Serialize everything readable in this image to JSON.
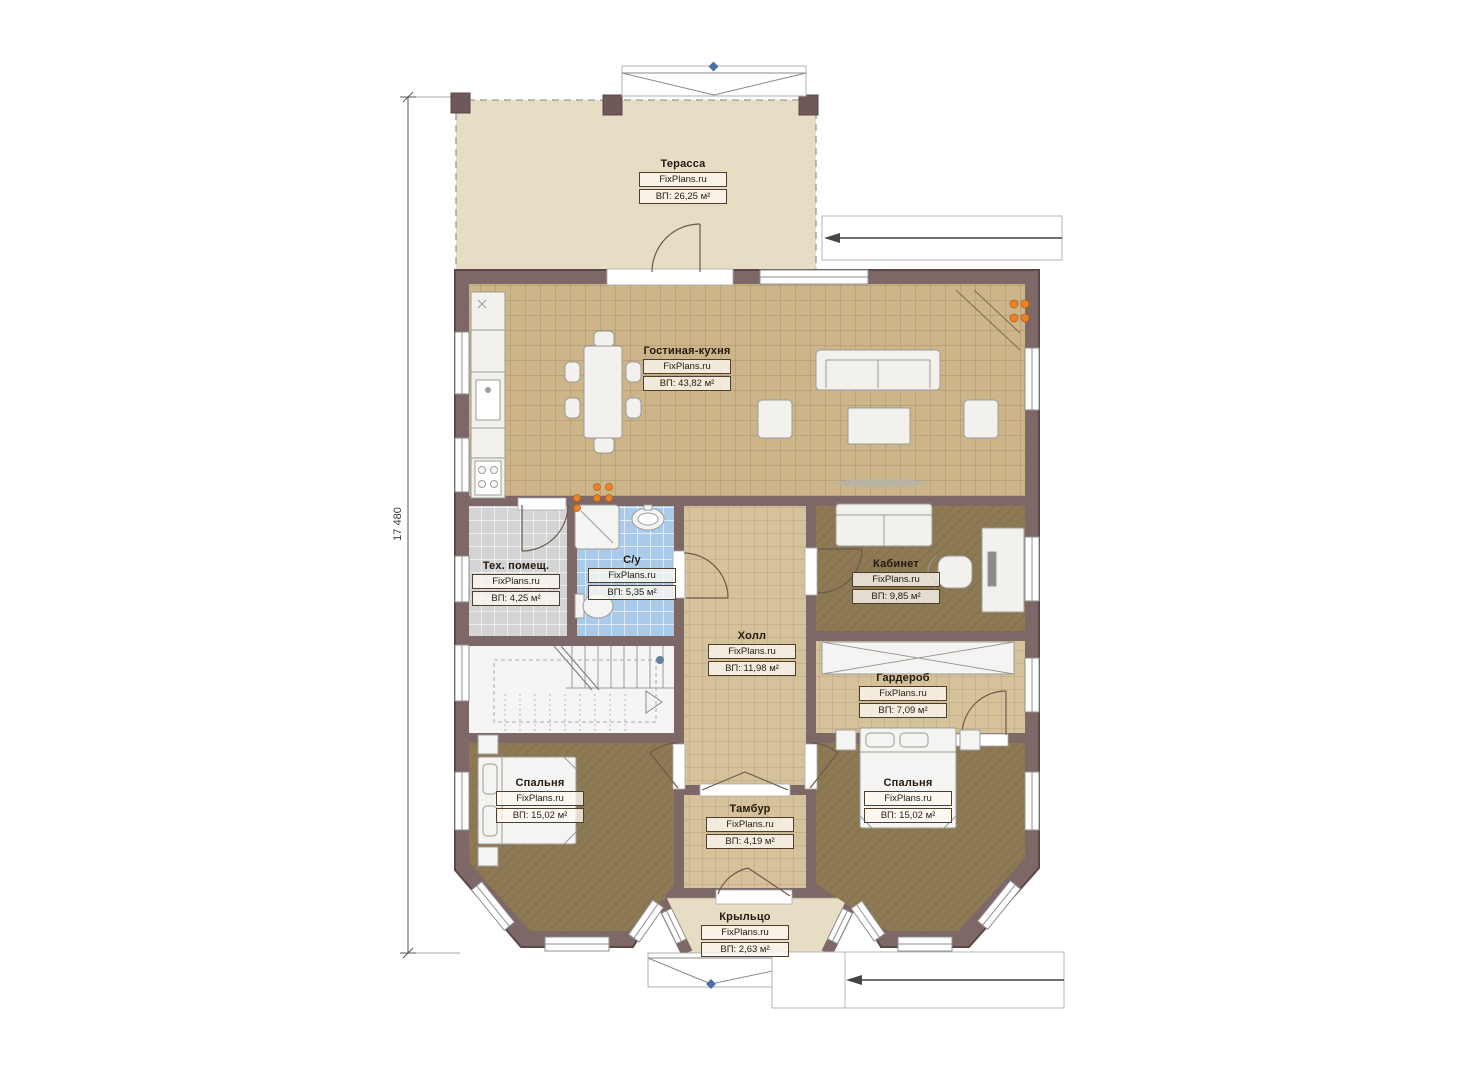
{
  "title": "План 1 этажа",
  "brand": "FixPlans.ru",
  "dimension": {
    "value": "17 480"
  },
  "rooms": [
    {
      "id": "terrace",
      "name": "Терасса",
      "brand": "FixPlans.ru",
      "area": "ВП: 26,25 м²"
    },
    {
      "id": "living-kitchen",
      "name": "Гостиная-кухня",
      "brand": "FixPlans.ru",
      "area": "ВП: 43,82 м²"
    },
    {
      "id": "tech-room",
      "name": "Тех. помещ.",
      "brand": "FixPlans.ru",
      "area": "ВП: 4,25 м²"
    },
    {
      "id": "bathroom",
      "name": "С/у",
      "brand": "FixPlans.ru",
      "area": "ВП: 5,35 м²"
    },
    {
      "id": "office",
      "name": "Кабинет",
      "brand": "FixPlans.ru",
      "area": "ВП: 9,85 м²"
    },
    {
      "id": "hall",
      "name": "Холл",
      "brand": "FixPlans.ru",
      "area": "ВП: 11,98 м²"
    },
    {
      "id": "wardrobe",
      "name": "Гардероб",
      "brand": "FixPlans.ru",
      "area": "ВП: 7,09 м²"
    },
    {
      "id": "bedroom-left",
      "name": "Спальня",
      "brand": "FixPlans.ru",
      "area": "ВП: 15,02 м²"
    },
    {
      "id": "bedroom-right",
      "name": "Спальня",
      "brand": "FixPlans.ru",
      "area": "ВП: 15,02 м²"
    },
    {
      "id": "vestibule",
      "name": "Тамбур",
      "brand": "FixPlans.ru",
      "area": "ВП: 4,19 м²"
    },
    {
      "id": "porch",
      "name": "Крыльцо",
      "brand": "FixPlans.ru",
      "area": "ВП: 2,63 м²"
    }
  ],
  "colors": {
    "wall": "#7d6767",
    "wall_edge": "#5a4747",
    "terrace_floor": "#e7dcc4",
    "living_tile": "#cdb58a",
    "hall_tile": "#d5c29a",
    "tech_tile": "#d6d6d6",
    "bathroom_tile": "#a9cbe9",
    "carpet": "#8d7953",
    "stairs_floor": "#f5f5f3",
    "heating_dot": "#e8832a",
    "axis_marker": "#4a6fa5"
  }
}
